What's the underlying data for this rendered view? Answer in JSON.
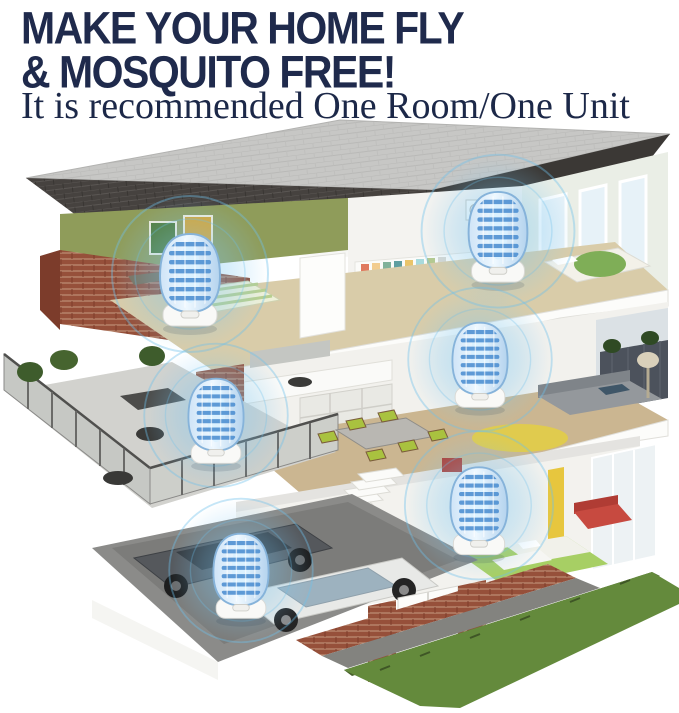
{
  "header": {
    "headline_line1": "MAKE YOUR HOME FLY",
    "headline_line2": "& MOSQUITO FREE!",
    "subtitle": "It is recommended One Room/One Unit"
  },
  "illustration": {
    "alt": "Three-story cutaway house showing a glowing insect-killer unit placed in every room",
    "unit_count": 6,
    "devices": [
      {
        "id": "unit-top-left-bedroom",
        "x": 190,
        "y": 280,
        "scale": 1.0
      },
      {
        "id": "unit-top-right-bedroom",
        "x": 498,
        "y": 237,
        "scale": 0.98
      },
      {
        "id": "unit-kitchen",
        "x": 216,
        "y": 421,
        "scale": 0.92
      },
      {
        "id": "unit-living-room",
        "x": 480,
        "y": 365,
        "scale": 0.92
      },
      {
        "id": "unit-ground-bedroom",
        "x": 479,
        "y": 511,
        "scale": 0.95
      },
      {
        "id": "unit-garage",
        "x": 241,
        "y": 576,
        "scale": 0.92
      }
    ],
    "colors": {
      "headline_text": "#1f2a4c",
      "device_glow": "#6ec0ea",
      "device_body": "#bcd9f2",
      "device_grid": "#4b8dd0",
      "roof_dark": "#46423f",
      "roof_light": "#c7c7c5",
      "brick": "#96503a",
      "accent_wall_green": "#8f9c5a",
      "wood_floor": "#cbb691",
      "grass": "#648a3c"
    }
  }
}
